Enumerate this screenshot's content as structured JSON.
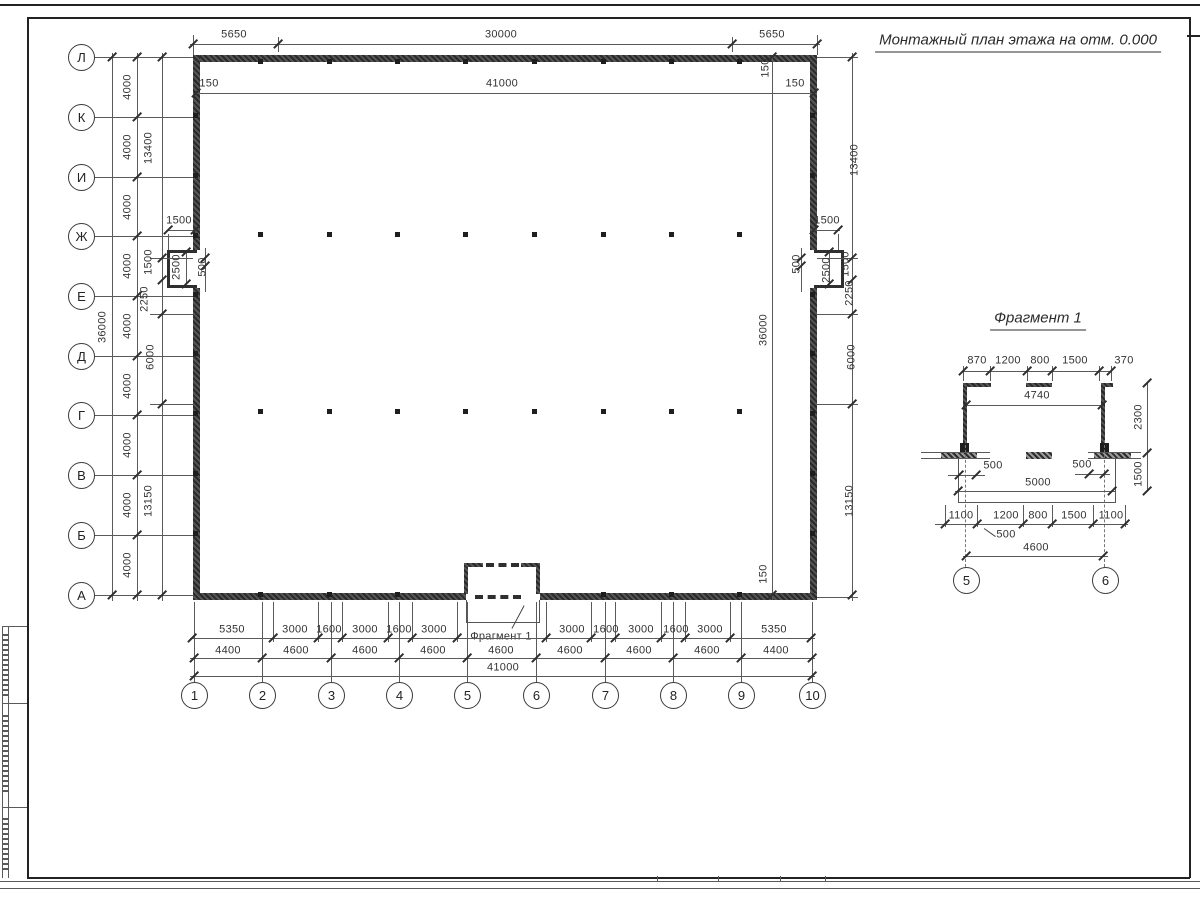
{
  "page": {
    "title": "Монтажный план этажа на отм. 0.000"
  },
  "fragment": {
    "title": "Фрагмент 1",
    "callout": "Фрагмент 1",
    "axis_circles": [
      {
        "label": "5",
        "x": 966,
        "y": 580
      },
      {
        "label": "6",
        "x": 1105,
        "y": 580
      }
    ]
  },
  "axes": {
    "left": [
      {
        "label": "Л",
        "y": 57
      },
      {
        "label": "К",
        "y": 117
      },
      {
        "label": "И",
        "y": 177
      },
      {
        "label": "Ж",
        "y": 236
      },
      {
        "label": "Е",
        "y": 296
      },
      {
        "label": "Д",
        "y": 356
      },
      {
        "label": "Г",
        "y": 415
      },
      {
        "label": "В",
        "y": 475
      },
      {
        "label": "Б",
        "y": 535
      },
      {
        "label": "А",
        "y": 595
      }
    ],
    "bottom": [
      {
        "label": "1",
        "x": 194
      },
      {
        "label": "2",
        "x": 262
      },
      {
        "label": "3",
        "x": 331
      },
      {
        "label": "4",
        "x": 399
      },
      {
        "label": "5",
        "x": 467
      },
      {
        "label": "6",
        "x": 536
      },
      {
        "label": "7",
        "x": 605
      },
      {
        "label": "8",
        "x": 673
      },
      {
        "label": "9",
        "x": 741
      },
      {
        "label": "10",
        "x": 812
      }
    ]
  },
  "dim_labels": [
    {
      "t": "5650",
      "x": 234,
      "y": 35
    },
    {
      "t": "30000",
      "x": 501,
      "y": 35
    },
    {
      "t": "5650",
      "x": 772,
      "y": 35
    },
    {
      "t": "150",
      "x": 209,
      "y": 84
    },
    {
      "t": "41000",
      "x": 502,
      "y": 84
    },
    {
      "t": "150",
      "x": 795,
      "y": 84
    },
    {
      "t": "150",
      "x": 766,
      "y": 68,
      "r": 1
    },
    {
      "t": "36000",
      "x": 103,
      "y": 327,
      "r": 1
    },
    {
      "t": "4000",
      "x": 128,
      "y": 87,
      "r": 1
    },
    {
      "t": "4000",
      "x": 128,
      "y": 147,
      "r": 1
    },
    {
      "t": "4000",
      "x": 128,
      "y": 207,
      "r": 1
    },
    {
      "t": "4000",
      "x": 128,
      "y": 266,
      "r": 1
    },
    {
      "t": "4000",
      "x": 128,
      "y": 326,
      "r": 1
    },
    {
      "t": "4000",
      "x": 128,
      "y": 386,
      "r": 1
    },
    {
      "t": "4000",
      "x": 128,
      "y": 445,
      "r": 1
    },
    {
      "t": "4000",
      "x": 128,
      "y": 505,
      "r": 1
    },
    {
      "t": "4000",
      "x": 128,
      "y": 565,
      "r": 1
    },
    {
      "t": "13400",
      "x": 149,
      "y": 148,
      "r": 1
    },
    {
      "t": "1500",
      "x": 149,
      "y": 262,
      "r": 1
    },
    {
      "t": "2250",
      "x": 145,
      "y": 299,
      "r": 1
    },
    {
      "t": "6000",
      "x": 151,
      "y": 357,
      "r": 1
    },
    {
      "t": "13150",
      "x": 149,
      "y": 501,
      "r": 1
    },
    {
      "t": "1500",
      "x": 179,
      "y": 221
    },
    {
      "t": "2500",
      "x": 177,
      "y": 267,
      "r": 1
    },
    {
      "t": "500",
      "x": 203,
      "y": 267,
      "r": 1
    },
    {
      "t": "1500",
      "x": 827,
      "y": 221
    },
    {
      "t": "500",
      "x": 797,
      "y": 264,
      "r": 1
    },
    {
      "t": "2500",
      "x": 827,
      "y": 270,
      "r": 1
    },
    {
      "t": "1500",
      "x": 846,
      "y": 264,
      "r": 1
    },
    {
      "t": "2250",
      "x": 850,
      "y": 293,
      "r": 1
    },
    {
      "t": "13400",
      "x": 855,
      "y": 160,
      "r": 1
    },
    {
      "t": "6000",
      "x": 852,
      "y": 357,
      "r": 1
    },
    {
      "t": "13150",
      "x": 850,
      "y": 501,
      "r": 1
    },
    {
      "t": "36000",
      "x": 764,
      "y": 330,
      "r": 1
    },
    {
      "t": "150",
      "x": 764,
      "y": 574,
      "r": 1
    },
    {
      "t": "5350",
      "x": 232,
      "y": 630
    },
    {
      "t": "3000",
      "x": 295,
      "y": 630
    },
    {
      "t": "1600",
      "x": 329,
      "y": 630
    },
    {
      "t": "3000",
      "x": 365,
      "y": 630
    },
    {
      "t": "1600",
      "x": 399,
      "y": 630
    },
    {
      "t": "3000",
      "x": 434,
      "y": 630
    },
    {
      "t": "3000",
      "x": 572,
      "y": 630
    },
    {
      "t": "1600",
      "x": 606,
      "y": 630
    },
    {
      "t": "3000",
      "x": 641,
      "y": 630
    },
    {
      "t": "1600",
      "x": 676,
      "y": 630
    },
    {
      "t": "3000",
      "x": 710,
      "y": 630
    },
    {
      "t": "5350",
      "x": 774,
      "y": 630
    },
    {
      "t": "4400",
      "x": 228,
      "y": 651
    },
    {
      "t": "4600",
      "x": 296,
      "y": 651
    },
    {
      "t": "4600",
      "x": 365,
      "y": 651
    },
    {
      "t": "4600",
      "x": 433,
      "y": 651
    },
    {
      "t": "4600",
      "x": 501,
      "y": 651
    },
    {
      "t": "4600",
      "x": 570,
      "y": 651
    },
    {
      "t": "4600",
      "x": 639,
      "y": 651
    },
    {
      "t": "4600",
      "x": 707,
      "y": 651
    },
    {
      "t": "4400",
      "x": 776,
      "y": 651
    },
    {
      "t": "41000",
      "x": 503,
      "y": 668
    },
    {
      "t": "870",
      "x": 977,
      "y": 361
    },
    {
      "t": "1200",
      "x": 1008,
      "y": 361
    },
    {
      "t": "800",
      "x": 1040,
      "y": 361
    },
    {
      "t": "1500",
      "x": 1075,
      "y": 361
    },
    {
      "t": "370",
      "x": 1124,
      "y": 361
    },
    {
      "t": "4740",
      "x": 1037,
      "y": 396
    },
    {
      "t": "2300",
      "x": 1139,
      "y": 417,
      "r": 1
    },
    {
      "t": "500",
      "x": 993,
      "y": 466
    },
    {
      "t": "500",
      "x": 1082,
      "y": 465
    },
    {
      "t": "5000",
      "x": 1038,
      "y": 483
    },
    {
      "t": "1500",
      "x": 1139,
      "y": 474,
      "r": 1
    },
    {
      "t": "1100",
      "x": 961,
      "y": 516
    },
    {
      "t": "1200",
      "x": 1006,
      "y": 516
    },
    {
      "t": "800",
      "x": 1038,
      "y": 516
    },
    {
      "t": "1500",
      "x": 1074,
      "y": 516
    },
    {
      "t": "1100",
      "x": 1111,
      "y": 516
    },
    {
      "t": "500",
      "x": 1006,
      "y": 535
    },
    {
      "t": "4600",
      "x": 1036,
      "y": 548
    }
  ]
}
